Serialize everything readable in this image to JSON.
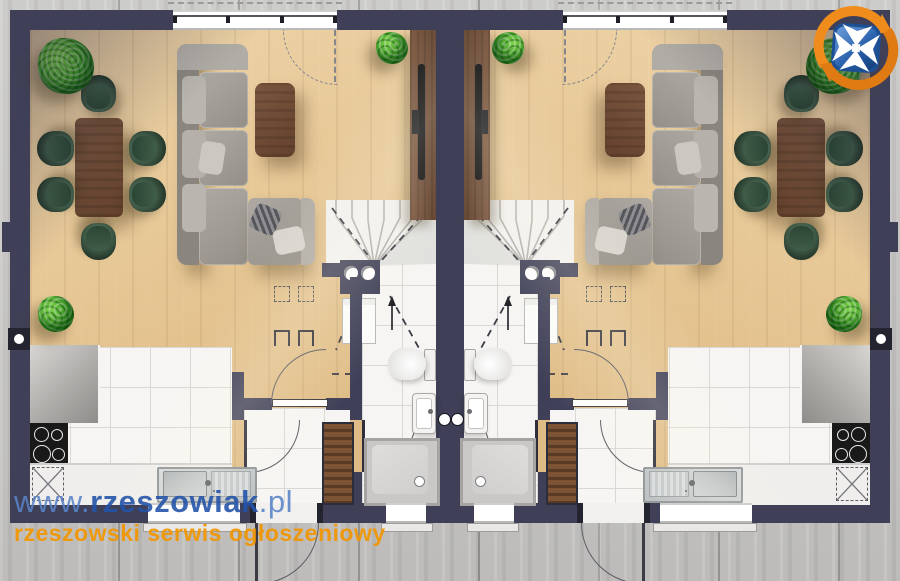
{
  "watermark": {
    "url_prefix": "www.",
    "brand": "rzeszowiak",
    "tld": ".pl",
    "tagline": "rzeszowski serwis ogłoszeniowy"
  },
  "logo": {
    "icon": "rzeszowiak-cross-logo",
    "description": "white maltese cross on blue rounded square encircled by two orange arrows"
  },
  "colors": {
    "wall": "#3f4058",
    "wood_floor": "#e7c796",
    "tile_floor": "#f6f5f3",
    "exterior_concrete": "#c7c6c4",
    "plant_green": "#2f8f1f",
    "chair_green": "#2c4233",
    "furniture_walnut": "#6e4c38",
    "sofa_gray": "#a09c95",
    "brand_blue": "#2a5ca8",
    "brand_light_blue": "#5882c6",
    "brand_orange": "#f29600"
  },
  "floorplan": {
    "type": "residential ground-floor plan",
    "layout": "two mirrored semi-detached units sharing a central party wall",
    "units": [
      "left-unit",
      "right-unit (mirror copy)"
    ],
    "rooms_per_unit": [
      {
        "name": "living-dining room",
        "floor": "wood",
        "furniture": [
          "corner sofa",
          "coffee table",
          "TV cabinet with wall TV",
          "dining table",
          "6 tub chairs",
          "potted plants"
        ],
        "openings": [
          "wide window with dashed terrace-door swing (top wall)"
        ]
      },
      {
        "name": "kitchen",
        "floor": "white tile",
        "fixtures": [
          "L-shaped worktop",
          "4-burner cooktop",
          "sink with drainer",
          "fridge dashed symbol"
        ],
        "openings": [
          "window (bottom wall)"
        ]
      },
      {
        "name": "hall and vestibule",
        "floor": "wood + tile",
        "fixtures": [
          "slatted wardrobe",
          "three interior door swings"
        ],
        "openings": [
          "entrance door swinging outside (bottom wall)"
        ]
      },
      {
        "name": "bathroom",
        "floor": "white tile",
        "fixtures": [
          "toilet",
          "wall-hung washbasin",
          "square shower tray with drain",
          "dark double-basin unit",
          "washing machine outline"
        ],
        "openings": [
          "window (bottom wall)"
        ]
      },
      {
        "name": "staircase",
        "detail": "winder stair along party wall, up arrow, dashed flight-above lines"
      }
    ],
    "wall_symbols": [
      "ventilation grilles (white circles)",
      "party-wall pipe circles",
      "door swing arcs",
      "dashed roof overhang over windows"
    ]
  }
}
